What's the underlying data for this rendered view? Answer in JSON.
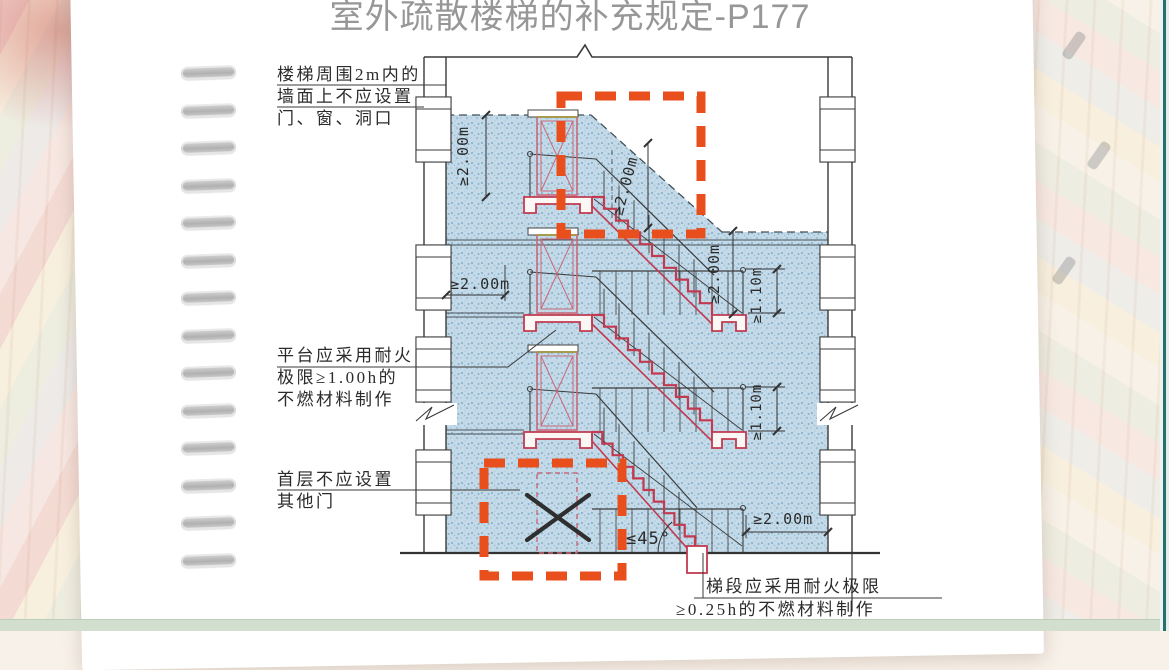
{
  "slide": {
    "title": "室外疏散楼梯的补充规定-P177"
  },
  "annotations": {
    "wall_zone": {
      "line1": "楼梯周围2m内的",
      "line2": "墙面上不应设置",
      "line3": "门、窗、洞口"
    },
    "platform": {
      "line1": "平台应采用耐火",
      "line2": "极限≥1.00h的",
      "line3": "不燃材料制作"
    },
    "first_floor": {
      "line1": "首层不应设置",
      "line2": "其他门"
    },
    "flight": {
      "line1": "梯段应采用耐火极限",
      "line2": "≥0.25h的不燃材料制作"
    }
  },
  "dimensions": {
    "left_height": "≥2.00m",
    "diagonal": "≥2.00m",
    "landing_width": "≥2.00m",
    "right_height": "≥2.00m",
    "railing_upper": "≥1.10m",
    "railing_lower": "≥1.10m",
    "ground_clearance": "≥2.00m",
    "slope_angle": "≤45°"
  },
  "colors": {
    "highlight_dashed": "#e84f1d",
    "stair_red": "#c23a50",
    "door_pink": "#c9697a",
    "zone_blue": "#c3d9e7",
    "title_gray": "#979797",
    "line_dark": "#3a3a3a",
    "edge_teal": "#256f6e",
    "bottom_band": "#d2dfcf"
  }
}
